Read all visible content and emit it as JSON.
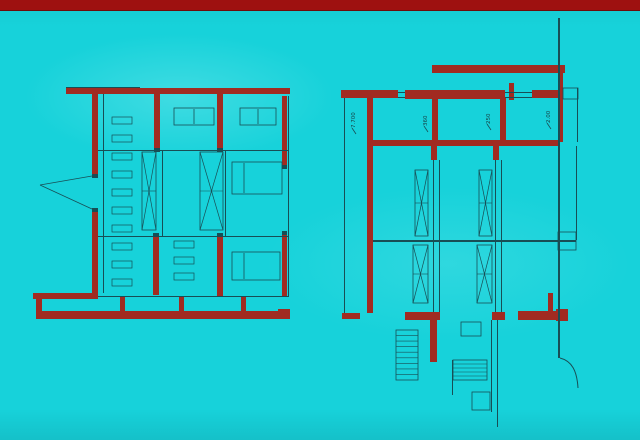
{
  "colors": {
    "background": "#17d2da",
    "top_bar": "#9e1110",
    "wall": "#a12b21",
    "line": "#184e55",
    "label": "#173c40"
  },
  "dimension_labels": {
    "left_height": "7.700",
    "bay_1": "360",
    "bay_2": "250",
    "bay_3": "2.00"
  },
  "left_plan": {
    "walls": [
      [
        66,
        88,
        224,
        6
      ],
      [
        92,
        94,
        6,
        82
      ],
      [
        92,
        210,
        6,
        85
      ],
      [
        33,
        293,
        65,
        6
      ],
      [
        36,
        299,
        6,
        14
      ],
      [
        36,
        311,
        252,
        8
      ],
      [
        278,
        309,
        12,
        10
      ],
      [
        120,
        296,
        5,
        15
      ],
      [
        179,
        296,
        5,
        15
      ],
      [
        241,
        296,
        5,
        15
      ],
      [
        154,
        94,
        6,
        56
      ],
      [
        217,
        94,
        6,
        56
      ],
      [
        282,
        96,
        5,
        71
      ],
      [
        153,
        237,
        6,
        58
      ],
      [
        217,
        237,
        6,
        60
      ],
      [
        282,
        235,
        5,
        62
      ]
    ],
    "lines": [
      [
        103,
        94,
        1,
        199
      ],
      [
        162,
        150,
        1,
        87
      ],
      [
        225,
        150,
        1,
        87
      ],
      [
        288,
        96,
        1,
        201
      ],
      [
        98,
        150,
        190,
        1
      ],
      [
        98,
        236,
        190,
        1
      ],
      [
        98,
        296,
        190,
        1
      ],
      [
        66,
        87,
        74,
        1
      ],
      [
        154,
        148,
        6,
        4
      ],
      [
        217,
        148,
        6,
        4
      ],
      [
        153,
        233,
        6,
        4
      ],
      [
        217,
        233,
        6,
        4
      ],
      [
        282,
        165,
        5,
        4
      ],
      [
        282,
        231,
        5,
        4
      ],
      [
        92,
        174,
        6,
        4
      ],
      [
        92,
        208,
        6,
        4
      ]
    ],
    "segs": [
      [
        40,
        185,
        92,
        176
      ],
      [
        40,
        185,
        92,
        209
      ],
      [
        194,
        109,
        194,
        124
      ],
      [
        258,
        109,
        258,
        124
      ],
      [
        244,
        163,
        244,
        193
      ],
      [
        244,
        253,
        244,
        279
      ]
    ],
    "boxes": [
      [
        174,
        108,
        40,
        17
      ],
      [
        240,
        108,
        36,
        17
      ],
      [
        232,
        162,
        50,
        32
      ],
      [
        232,
        252,
        48,
        28
      ]
    ],
    "rungs": [
      [
        112,
        117,
        20,
        7
      ],
      [
        112,
        135,
        20,
        7
      ],
      [
        112,
        153,
        20,
        7
      ],
      [
        112,
        171,
        20,
        7
      ],
      [
        112,
        189,
        20,
        7
      ],
      [
        112,
        207,
        20,
        7
      ],
      [
        112,
        225,
        20,
        7
      ],
      [
        112,
        243,
        20,
        7
      ],
      [
        112,
        261,
        20,
        7
      ],
      [
        112,
        279,
        20,
        7
      ],
      [
        174,
        241,
        20,
        7
      ],
      [
        174,
        257,
        20,
        7
      ],
      [
        174,
        273,
        20,
        7
      ]
    ],
    "xboxes": [
      [
        142,
        152,
        14,
        78
      ],
      [
        200,
        152,
        23,
        78
      ]
    ],
    "stairs": [],
    "arcs": [],
    "labels": []
  },
  "right_plan": {
    "walls": [
      [
        432,
        65,
        133,
        8
      ],
      [
        341,
        90,
        57,
        8
      ],
      [
        405,
        90,
        100,
        9
      ],
      [
        509,
        83,
        5,
        17
      ],
      [
        532,
        90,
        30,
        8
      ],
      [
        558,
        70,
        5,
        72
      ],
      [
        367,
        98,
        6,
        215
      ],
      [
        370,
        140,
        188,
        6
      ],
      [
        432,
        98,
        6,
        42
      ],
      [
        500,
        98,
        6,
        42
      ],
      [
        431,
        146,
        6,
        14
      ],
      [
        493,
        146,
        6,
        14
      ],
      [
        342,
        313,
        18,
        6
      ],
      [
        405,
        312,
        35,
        8
      ],
      [
        492,
        312,
        13,
        8
      ],
      [
        518,
        311,
        39,
        9
      ],
      [
        556,
        309,
        12,
        12
      ],
      [
        430,
        318,
        7,
        44
      ],
      [
        548,
        293,
        5,
        18
      ]
    ],
    "lines": [
      [
        558,
        18,
        2,
        340
      ],
      [
        344,
        98,
        1,
        215
      ],
      [
        433,
        160,
        1,
        152
      ],
      [
        439,
        160,
        1,
        152
      ],
      [
        495,
        160,
        1,
        152
      ],
      [
        501,
        160,
        1,
        152
      ],
      [
        373,
        240,
        203,
        2
      ],
      [
        398,
        92,
        7,
        1
      ],
      [
        398,
        97,
        7,
        1
      ],
      [
        505,
        92,
        27,
        1
      ],
      [
        505,
        97,
        27,
        1
      ],
      [
        577,
        88,
        1,
        54
      ],
      [
        576,
        146,
        1,
        94
      ],
      [
        491,
        320,
        1,
        92
      ],
      [
        497,
        320,
        1,
        107
      ],
      [
        452,
        360,
        1,
        35
      ]
    ],
    "segs": [
      [
        352,
        128,
        356,
        134
      ],
      [
        424,
        126,
        428,
        132
      ],
      [
        487,
        124,
        491,
        130
      ],
      [
        547,
        123,
        551,
        129
      ]
    ],
    "boxes": [
      [
        563,
        88,
        15,
        11
      ],
      [
        558,
        232,
        18,
        18
      ],
      [
        461,
        322,
        20,
        14
      ],
      [
        472,
        392,
        18,
        18
      ]
    ],
    "rungs": [],
    "xboxes": [
      [
        415,
        170,
        13,
        66
      ],
      [
        413,
        245,
        15,
        58
      ],
      [
        479,
        170,
        13,
        66
      ],
      [
        477,
        245,
        15,
        58
      ]
    ],
    "stairs": [
      {
        "r": [
          453,
          360,
          34,
          20
        ],
        "n": 5
      },
      {
        "r": [
          396,
          330,
          22,
          50
        ],
        "n": 9
      }
    ],
    "arcs": [
      "M 560 358 C 572 361 577 371 578 388"
    ],
    "labels": [
      {
        "key": "left_height",
        "x": 355,
        "y": 128
      },
      {
        "key": "bay_1",
        "x": 427,
        "y": 126
      },
      {
        "key": "bay_2",
        "x": 490,
        "y": 124
      },
      {
        "key": "bay_3",
        "x": 550,
        "y": 123
      }
    ]
  }
}
